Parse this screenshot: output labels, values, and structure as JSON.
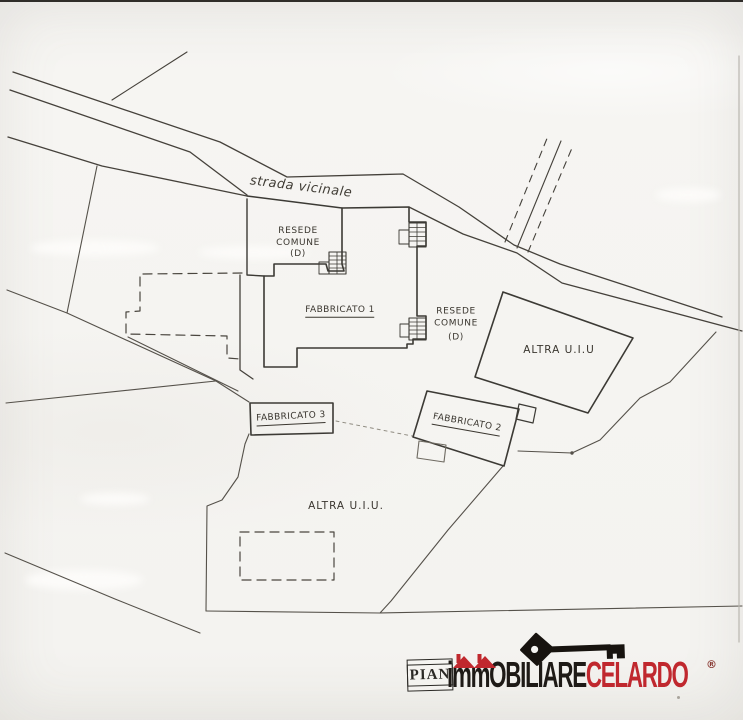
{
  "plan": {
    "road_label": "strada vicinale",
    "resede_common_1": {
      "line1": "RESEDE",
      "line2": "COMUNE",
      "line3": "(D)"
    },
    "resede_common_2": {
      "line1": "RESEDE",
      "line2": "COMUNE",
      "line3": "(D)"
    },
    "building1_label": "FABBRICATO 1",
    "building2_label": "FABBRICATO 2",
    "building3_label": "FABBRICATO 3",
    "other_unit_right_label": "ALTRA U.I.U",
    "other_unit_bottom_label": "ALTRA U.I.U.",
    "line_color": "#45413b"
  },
  "logo": {
    "stamp_text": "PIAN",
    "brand_part1": "imm",
    "brand_part2": "OBILIARE",
    "brand_part3": "CELARDO",
    "registered_mark": "®",
    "black": "#1e1a16",
    "red": "#c0282e",
    "icons": [
      "key-icon",
      "house-roof-icon",
      "stairs-icon"
    ]
  }
}
